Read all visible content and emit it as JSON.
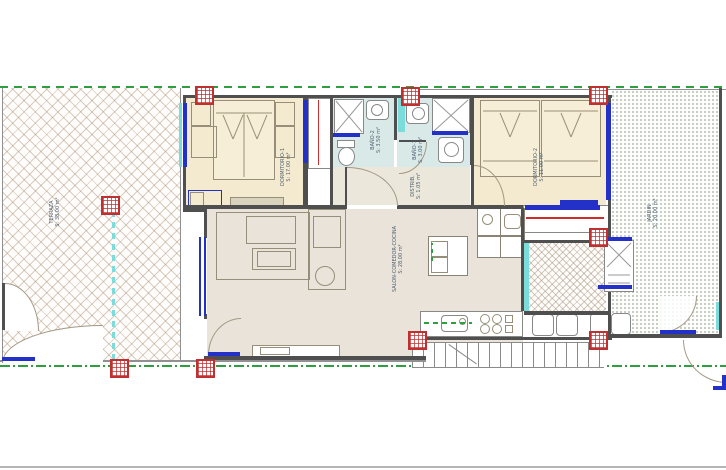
{
  "colors": {
    "boundary_green": "#2f9e3f",
    "wall_dark": "#4f4f4f",
    "window_blue": "#2431c8",
    "glazing_cyan": "#7bdcdc",
    "accent_red": "#cc2e2e",
    "bedroom_floor": "#f4ead0",
    "bathroom_floor": "#d9e9e7",
    "living_floor": "#eae3d9",
    "hatch_line": "#a58769",
    "garden_dot": "#6e876e"
  },
  "rooms": {
    "terraza": {
      "name": "TERRAZA",
      "area": "S: 38.00 m²"
    },
    "dormitorio1": {
      "name": "DORMITORIO-1",
      "area": "S: 17.00 m²"
    },
    "banyo2": {
      "name": "BAÑO-2",
      "area": "S: 3.50 m²"
    },
    "distribuidor": {
      "name": "DISTRIB.",
      "area": "S: 1.05 m²"
    },
    "banyo1": {
      "name": "BAÑO-1",
      "area": "S: 3.00 m²"
    },
    "dormitorio2": {
      "name": "DORMITORIO-2",
      "area": "S: 11.00 m²"
    },
    "salon": {
      "name": "SALON-COMEDOR-COCINA",
      "area": "S: 28.00 m²"
    },
    "jardin": {
      "name": "JARDIN",
      "area": "S: 20.00 m²"
    }
  }
}
